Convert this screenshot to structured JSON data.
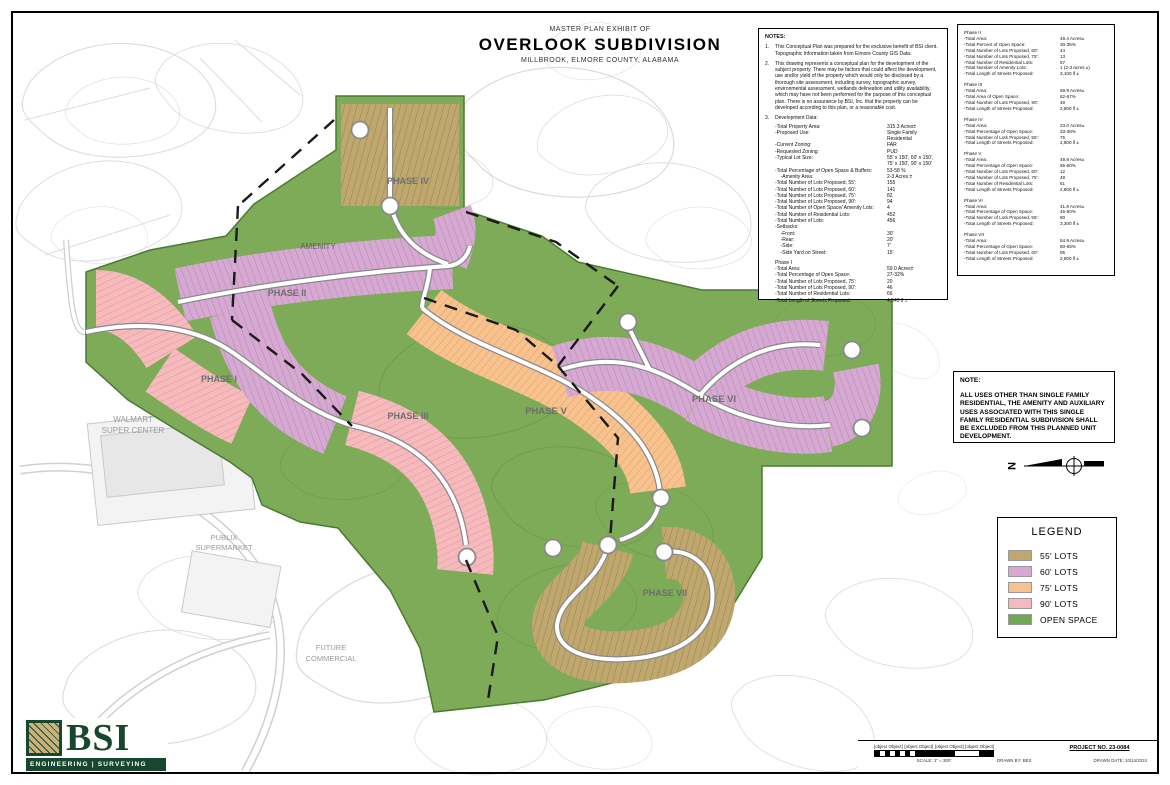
{
  "sheet": {
    "title_small": "MASTER PLAN EXHIBIT OF",
    "title_main": "OVERLOOK SUBDIVISION",
    "title_sub": "MILLBROOK, ELMORE COUNTY, ALABAMA"
  },
  "notes_box": {
    "heading": "NOTES:",
    "note1_num": "1.",
    "note1": "This Conceptual Plan was prepared for the exclusive benefit of BSI client. Topographic Information taken from Elmore County GIS Data.",
    "note2_num": "2.",
    "note2": "This drawing represents a conceptual plan for the development of the subject property.  There may be factors that could affect the development, use and/or yield of the property which would only be disclosed by a thorough site assessment, including survey, topographic survey, environmental assessment, wetlands delineation and utility availability, which may have not been performed for the purpose of this conceptual plan.  There is no assurance by BSI, Inc. that the property can be developed according to this plan, or a reasonable cost.",
    "note3_num": "3.",
    "note3": "Development Data:",
    "dev_rows": [
      {
        "label": "-Total Property Area:",
        "value": "315.3 Acres±"
      },
      {
        "label": "-Proposed Use:",
        "value": "Single Family Residential"
      },
      {
        "label": "-Current Zoning:",
        "value": "FAR"
      },
      {
        "label": "-Requested Zoning:",
        "value": "PUD"
      },
      {
        "label": "-Typical Lot Size:",
        "value": "55' x 150', 60' x 150', 75' x 150', 90' x 150'"
      },
      {
        "label": "-Total Percentage of Open Space & Buffers:",
        "value": "53-58 %"
      },
      {
        "label": "    -Amenity Area:",
        "value": "2-3 Acres ±"
      },
      {
        "label": "-Total Number of Lots Proposed, 55':",
        "value": "155"
      },
      {
        "label": "-Total Number of Lots Proposed, 60':",
        "value": "141"
      },
      {
        "label": "-Total Number of Lots Proposed, 75':",
        "value": "82"
      },
      {
        "label": "-Total Number of Lots Proposed, 90':",
        "value": "94"
      },
      {
        "label": "-Total Number of Open Space/ Amenity Lots:",
        "value": "4"
      },
      {
        "label": "-Total Number of Residential Lots:",
        "value": "452"
      },
      {
        "label": "-Total Number of Lots:",
        "value": "456"
      },
      {
        "label": "-Setbacks:",
        "value": ""
      },
      {
        "label": "    -Front:",
        "value": "30'"
      },
      {
        "label": "    -Rear:",
        "value": "20'"
      },
      {
        "label": "    -Side:",
        "value": "7'"
      },
      {
        "label": "    -Side Yard on Street:",
        "value": "15'"
      }
    ],
    "phase1_heading": "Phase I",
    "phase1_rows": [
      {
        "label": "-Total Area:",
        "value": "59.0 Acres±"
      },
      {
        "label": "-Total Percentage of Open Space:",
        "value": "27-32%"
      },
      {
        "label": "-Total Number of Lots Proposed, 75':",
        "value": "20"
      },
      {
        "label": "-Total Number of Lots Proposed, 90':",
        "value": "46"
      },
      {
        "label": "-Total Number of Residential Lots:",
        "value": "66"
      },
      {
        "label": "-Total Length of Streets Proposed:",
        "value": "4,043 lf ±"
      }
    ]
  },
  "phase_box": {
    "phases": [
      {
        "heading": "Phase II",
        "rows": [
          {
            "label": "-Total Area:",
            "value": "49.4 Acres±"
          },
          {
            "label": "-Total Percent of Open Space:",
            "value": "30-35%"
          },
          {
            "label": "-Total Number of Lots Proposed, 60':",
            "value": "44"
          },
          {
            "label": "-Total Number of Lots Proposed, 75':",
            "value": "13"
          },
          {
            "label": "-Total Number of Residential Lots:",
            "value": "57"
          },
          {
            "label": "-Total Number of Amenity Lots:",
            "value": "1 (2-3 acres ±)"
          },
          {
            "label": "-Total Length of Streets Proposed:",
            "value": "3,100 lf ±"
          }
        ]
      },
      {
        "heading": "Phase III",
        "rows": [
          {
            "label": "-Total Area:",
            "value": "59.9 Acres±"
          },
          {
            "label": "-Total Area of Open Space:",
            "value": "62-67%"
          },
          {
            "label": "-Total Number of Lots Proposed, 90':",
            "value": "48"
          },
          {
            "label": "-Total Length of Streets Proposed:",
            "value": "2,800 lf ±"
          }
        ]
      },
      {
        "heading": "Phase IV",
        "rows": [
          {
            "label": "-Total Area:",
            "value": "23.0 Acres±"
          },
          {
            "label": "-Total Percentage of Open Space:",
            "value": "33-38%"
          },
          {
            "label": "-Total Number of Lots Proposed, 55':",
            "value": "75"
          },
          {
            "label": "-Total Length of Streets Proposed:",
            "value": "2,800 lf ±"
          }
        ]
      },
      {
        "heading": "Phase V",
        "rows": [
          {
            "label": "-Total Area:",
            "value": "49.8 Acres±"
          },
          {
            "label": "-Total Percentage of Open Space:",
            "value": "55-60%"
          },
          {
            "label": "-Total Number of Lots Proposed, 60':",
            "value": "12"
          },
          {
            "label": "-Total Number of Lots Proposed, 75':",
            "value": "49"
          },
          {
            "label": "-Total Number of Residential Lots:",
            "value": "61"
          },
          {
            "label": "-Total Length of Streets Proposed:",
            "value": "2,800 lf ±"
          }
        ]
      },
      {
        "heading": "Phase VI",
        "rows": [
          {
            "label": "-Total Area:",
            "value": "41.8 Acres±"
          },
          {
            "label": "-Total Percentage of Open Space:",
            "value": "45-50%"
          },
          {
            "label": "-Total Number of Lots Proposed, 55':",
            "value": "80"
          },
          {
            "label": "-Total Length of Streets Proposed:",
            "value": "3,300 lf ±"
          }
        ]
      },
      {
        "heading": "Phase VII",
        "rows": [
          {
            "label": "-Total Area:",
            "value": "54.9 Acres±"
          },
          {
            "label": "-Total Percentage of Open Space:",
            "value": "60-65%"
          },
          {
            "label": "-Total Number of Lots Proposed, 60':",
            "value": "85"
          },
          {
            "label": "-Total Length of Streets Proposed:",
            "value": "2,800 lf ±"
          }
        ]
      }
    ]
  },
  "note_box": {
    "heading": "NOTE:",
    "body": "ALL USES OTHER THAN SINGLE FAMILY RESIDENTIAL, THE AMENITY AND AUXILIARY USES ASSOCIATED WITH THIS SINGLE FAMILY RESIDENTIAL SUBDIVISION SHALL BE EXCLUDED FROM THIS PLANNED UNIT DEVELOPMENT."
  },
  "legend": {
    "title": "LEGEND",
    "items": [
      {
        "label": "55' LOTS",
        "color": "#bfa76e"
      },
      {
        "label": "60' LOTS",
        "color": "#d6a9d2"
      },
      {
        "label": "75' LOTS",
        "color": "#f8c28f"
      },
      {
        "label": "90' LOTS",
        "color": "#f6babd"
      },
      {
        "label": "OPEN SPACE",
        "color": "#6fa953"
      }
    ]
  },
  "map": {
    "labels": {
      "phase1": "PHASE I",
      "phase2": "PHASE II",
      "phase3": "PHASE III",
      "phase4": "PHASE IV",
      "phase5": "PHASE V",
      "phase6": "PHASE VI",
      "phase7": "PHASE VII",
      "amenity": "AMENITY",
      "walmart1": "WALMART",
      "walmart2": "SUPER CENTER",
      "publix1": "PUBLIX",
      "publix2": "SUPERMARKET",
      "future1": "FUTURE",
      "future2": "COMMERCIAL"
    },
    "north_label": "N",
    "open_space_color": "#7dab58"
  },
  "brand": {
    "name": "BSI",
    "tagline": "ENGINEERING | SURVEYING"
  },
  "title_block": {
    "project_no": "PROJECT NO. 23-0084",
    "drawn_by": "DRAWN BY: BES",
    "drawn_date": "DRAWN DATE: 10/14/2024",
    "scale_label": "SCALE: 1\" = 300'",
    "scale_ticks": [
      "300",
      "0",
      "300",
      "600"
    ]
  }
}
